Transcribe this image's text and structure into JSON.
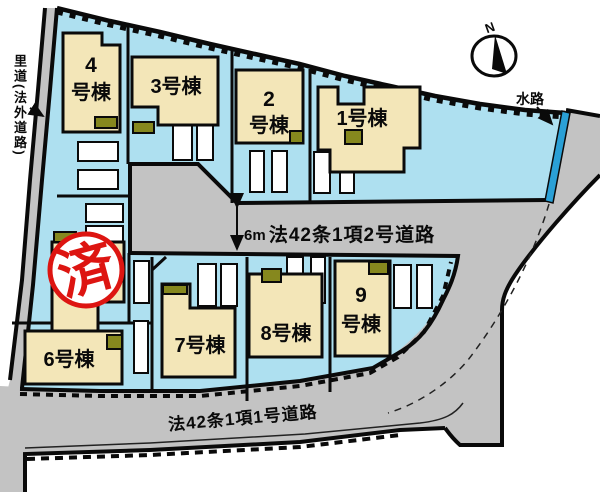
{
  "colors": {
    "plot_area": "#aee0f0",
    "building_fill": "#f3e6b8",
    "road_fill": "#c3c3c3",
    "waterway_blue": "#2aa0d6",
    "stamp_red": "#dd1511",
    "entrance_olive": "#86881e",
    "outline_black": "#0a0a0a"
  },
  "buildings": {
    "b1": {
      "line1": "1号棟"
    },
    "b2": {
      "line1": "2",
      "line2": "号棟"
    },
    "b3": {
      "line1": "3号棟"
    },
    "b4": {
      "line1": "4",
      "line2": "号棟"
    },
    "b6": {
      "line1": "6号棟"
    },
    "b7": {
      "line1": "7号棟"
    },
    "b8": {
      "line1": "8号棟"
    },
    "b9": {
      "line1": "9",
      "line2": "号棟"
    }
  },
  "labels": {
    "left_road": "里道(法外道路)",
    "waterway": "水路",
    "north": "N",
    "middle_road": "法42条1項2号道路",
    "bottom_road": "法42条1項1号道路",
    "road_width": "6m",
    "sold_stamp": "済"
  }
}
